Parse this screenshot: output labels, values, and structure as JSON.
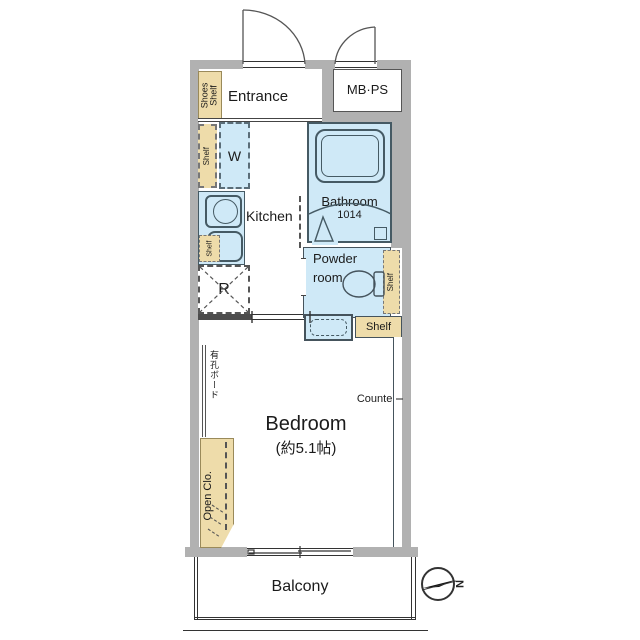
{
  "colors": {
    "wall": "#b1b1b1",
    "water": "#cfe9f7",
    "shelf": "#eedcaa"
  },
  "rooms": {
    "entrance": "Entrance",
    "mbps": "MB·PS",
    "kitchen": "Kitchen",
    "balcony": "Balcony"
  },
  "bathroom": {
    "name": "Bathroom",
    "size": "1014"
  },
  "powder": {
    "line1": "Powder",
    "line2": "room"
  },
  "bedroom": {
    "name": "Bedroom",
    "size": "(約5.1帖)"
  },
  "fixtures": {
    "washer": "W",
    "fridge": "R",
    "shelf": "Shelf",
    "shoes_shelf": "Shoes Shelf",
    "open_closet": "Open Clo.",
    "pegboard": "有孔ボード",
    "counter": "Counter"
  },
  "compass": {
    "north": "N"
  }
}
